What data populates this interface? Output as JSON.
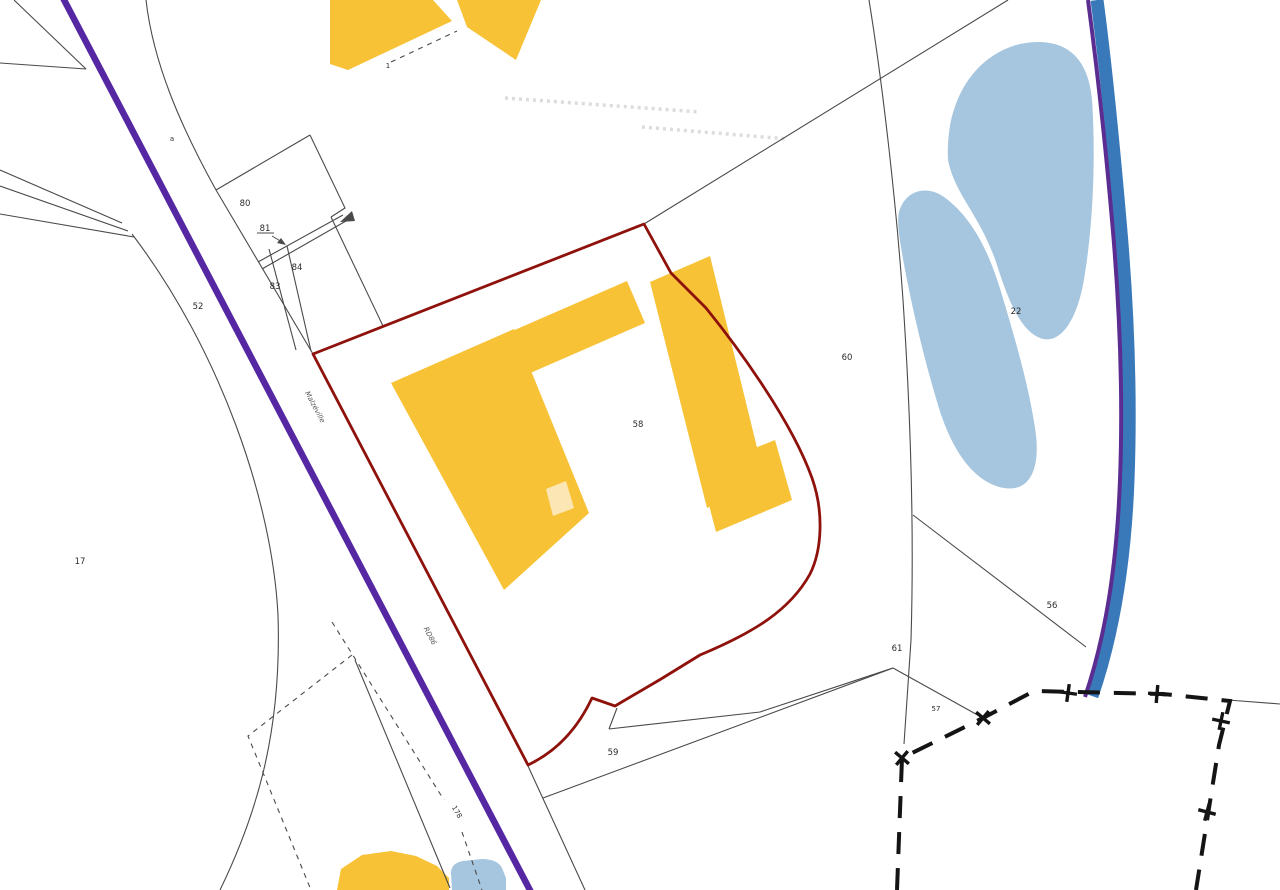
{
  "map": {
    "kind": "cadastral-parcel-map",
    "labels": {
      "p17": "17",
      "p22": "22",
      "p52": "52",
      "p56": "56",
      "p57": "57",
      "p58": "58",
      "p59": "59",
      "p60": "60",
      "p61": "61",
      "p80": "80",
      "p81": "81",
      "p83": "83",
      "p84": "84",
      "p178": "178",
      "sub1": "1",
      "suba": "a"
    },
    "road_labels": {
      "name": "Malzéville",
      "ref": "RD86"
    },
    "colors": {
      "background": "#FFFFFF",
      "building": "#F8C237",
      "building_light": "#FBE6B4",
      "pond": "#A6C6DF",
      "river": "#3A79B9",
      "river_edge": "#5B2D91",
      "road": "#5627A3",
      "selected_parcel_boundary": "#8E120B",
      "parcel_line": "#4A4A4A",
      "commune_boundary": "#141414",
      "faded_text": "#DCDCDC",
      "label_text": "#2B2B2B"
    }
  }
}
